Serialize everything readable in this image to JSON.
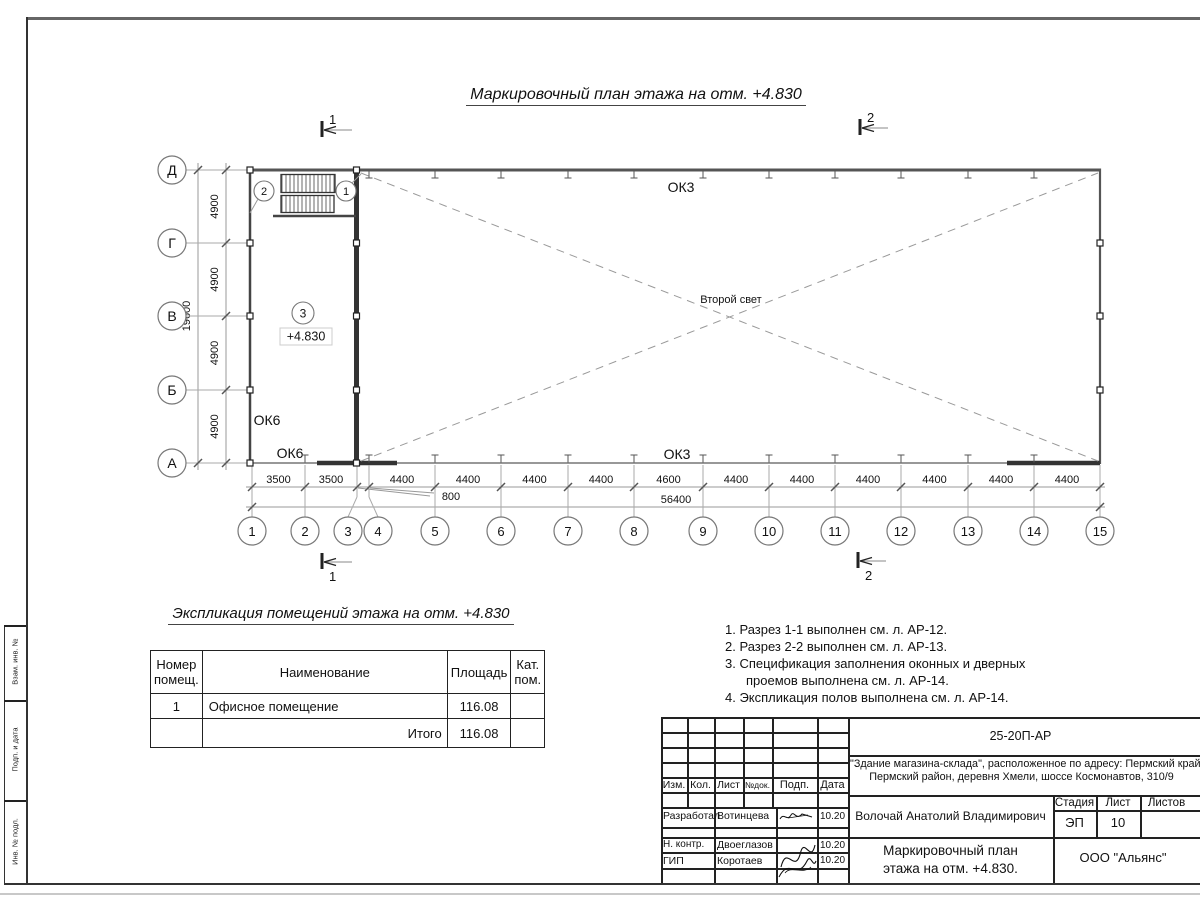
{
  "page": {
    "plan_title": "Маркировочный план этажа на отм. +4.830",
    "table_title": "Экспликация помещений этажа на отм. +4.830"
  },
  "plan": {
    "row_axes": [
      "Д",
      "Г",
      "В",
      "Б",
      "А"
    ],
    "row_dims": [
      "4900",
      "4900",
      "4900",
      "4900"
    ],
    "row_total": "19600",
    "col_axes": [
      "1",
      "2",
      "3",
      "4",
      "5",
      "6",
      "7",
      "8",
      "9",
      "10",
      "11",
      "12",
      "13",
      "14",
      "15"
    ],
    "col_dims": [
      "3500",
      "3500",
      "800",
      "4400",
      "4400",
      "4400",
      "4400",
      "4600",
      "4400",
      "4400",
      "4400",
      "4400",
      "4400",
      "4400"
    ],
    "col_total": "56400",
    "section_marks": {
      "s1": "1",
      "s2": "2"
    },
    "door_marks": {
      "left": "2",
      "right": "1"
    },
    "room_mark": "3",
    "elevation": "+4.830",
    "window_labels": {
      "ok3_top": "ОК3",
      "ok3_bottom": "ОК3",
      "ok6_upper": "ОК6",
      "ok6_lower": "ОК6"
    },
    "second_light": "Второй свет"
  },
  "notes": {
    "line1": "1. Разрез 1-1 выполнен см. л. АР-12.",
    "line2": "2. Разрез 2-2 выполнен см. л. АР-13.",
    "line3": "3. Спецификация заполнения оконных и дверных",
    "line4": "проемов выполнена см. л. АР-14.",
    "line5": "4. Экспликация полов выполнена см. л. АР-14."
  },
  "room_table": {
    "header": {
      "num1": "Номер",
      "num2": "помещ.",
      "name": "Наименование",
      "area": "Площадь",
      "cat1": "Кат.",
      "cat2": "пом."
    },
    "row": {
      "num": "1",
      "name": "Офисное помещение",
      "area": "116.08",
      "cat": ""
    },
    "total": {
      "label": "Итого",
      "area": "116.08"
    }
  },
  "title_block": {
    "doc_number": "25-20П-АР",
    "project_line1": "\"Здание магазина-склада\", расположенное по адресу: Пермский край,",
    "project_line2": "Пермский район, деревня Хмели, шоссе Космонавтов, 310/9",
    "rev_headers": {
      "izm": "Изм.",
      "kol": "Кол.",
      "list": "Лист",
      "ndok": "№док.",
      "podp": "Подп.",
      "data": "Дата"
    },
    "rows": {
      "developer_role": "Разработал",
      "developer_name": "Вотинцева",
      "developer_date": "10.20",
      "ncontr_role": "Н. контр.",
      "ncontr_name": "Двоеглазов",
      "ncontr_date": "10.20",
      "gip_role": "ГИП",
      "gip_name": "Коротаев",
      "gip_date": "10.20"
    },
    "chief": "Волочай Анатолий Владимирович",
    "sheet_name_line1": "Маркировочный план",
    "sheet_name_line2": "этажа на отм. +4.830.",
    "stage_header": "Стадия",
    "list_header": "Лист",
    "listov_header": "Листов",
    "stage": "ЭП",
    "list_num": "10",
    "listov": "",
    "company": "ООО \"Альянс\""
  },
  "side_stamp": {
    "top": "Взам. инв. №",
    "mid": "Подп. и дата",
    "bottom": "Инв. № подл."
  }
}
